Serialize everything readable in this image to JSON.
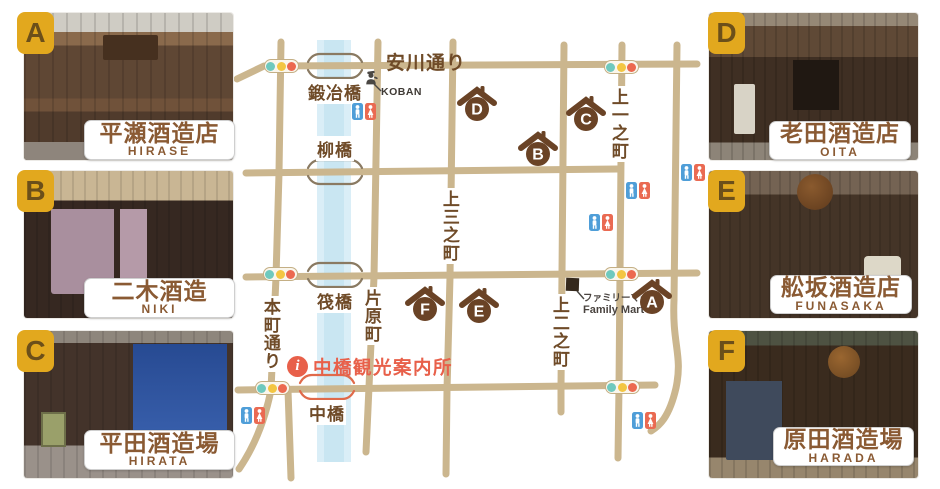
{
  "breweries": [
    {
      "letter": "A",
      "name_jp": "平瀬酒造店",
      "name_en": "HIRASE"
    },
    {
      "letter": "B",
      "name_jp": "二木酒造",
      "name_en": "NIKI"
    },
    {
      "letter": "C",
      "name_jp": "平田酒造場",
      "name_en": "HIRATA"
    },
    {
      "letter": "D",
      "name_jp": "老田酒造店",
      "name_en": "OITA"
    },
    {
      "letter": "E",
      "name_jp": "舩坂酒造店",
      "name_en": "FUNASAKA"
    },
    {
      "letter": "F",
      "name_jp": "原田酒造場",
      "name_en": "HARADA"
    }
  ],
  "map": {
    "street_labels": [
      {
        "text": "安川通り",
        "x": 386,
        "y": 48,
        "orientation": "h"
      },
      {
        "text": "本町通り",
        "x": 273,
        "y": 296,
        "orientation": "v"
      },
      {
        "text": "片原町",
        "x": 374,
        "y": 287,
        "orientation": "v"
      },
      {
        "text": "上三之町",
        "x": 452,
        "y": 188,
        "orientation": "v"
      },
      {
        "text": "上二之町",
        "x": 562,
        "y": 294,
        "orientation": "v"
      },
      {
        "text": "上一之町",
        "x": 621,
        "y": 86,
        "orientation": "v"
      }
    ],
    "bridges": [
      {
        "text": "鍛冶橋",
        "x": 335,
        "street_y": 66,
        "label_side": "below",
        "color": "#8a7a62"
      },
      {
        "text": "柳橋",
        "x": 335,
        "street_y": 172,
        "label_side": "above",
        "color": "#8a7a62"
      },
      {
        "text": "筏橋",
        "x": 335,
        "street_y": 275,
        "label_side": "below",
        "color": "#8a7a62"
      },
      {
        "text": "中橋",
        "x": 327,
        "street_y": 387,
        "label_side": "below",
        "color": "#e06a4a"
      }
    ],
    "markers": [
      {
        "letter": "D",
        "x": 477,
        "y": 86
      },
      {
        "letter": "C",
        "x": 586,
        "y": 96
      },
      {
        "letter": "B",
        "x": 538,
        "y": 131
      },
      {
        "letter": "F",
        "x": 425,
        "y": 286
      },
      {
        "letter": "E",
        "x": 479,
        "y": 288
      },
      {
        "letter": "A",
        "x": 652,
        "y": 279
      }
    ],
    "traffic_lights": [
      {
        "x": 281,
        "y": 66
      },
      {
        "x": 621,
        "y": 67
      },
      {
        "x": 280,
        "y": 274
      },
      {
        "x": 621,
        "y": 274
      },
      {
        "x": 272,
        "y": 388
      },
      {
        "x": 622,
        "y": 387
      }
    ],
    "toilets": [
      {
        "x": 352,
        "y": 103
      },
      {
        "x": 681,
        "y": 164
      },
      {
        "x": 626,
        "y": 182
      },
      {
        "x": 589,
        "y": 214
      },
      {
        "x": 241,
        "y": 407
      },
      {
        "x": 632,
        "y": 412
      }
    ],
    "koban": {
      "label": "KOBAN"
    },
    "family_mart": {
      "label_jp": "ファミリーマート",
      "label_en": "Family Mart"
    },
    "info_center": {
      "icon_text": "i",
      "label": "中橋観光案内所"
    },
    "colors": {
      "street": "#cbb68e",
      "river_outer": "#daeef7",
      "river_inner": "#c9e6f2",
      "brown": "#6b4326",
      "accent_orange": "#e8604a",
      "badge_gold": "#e2a81e",
      "toilet_blue": "#4f9ed8",
      "toilet_red": "#ea6a52",
      "signal_teal": "#6fc9be",
      "signal_yellow": "#f3c643",
      "signal_red": "#ec6950"
    }
  }
}
